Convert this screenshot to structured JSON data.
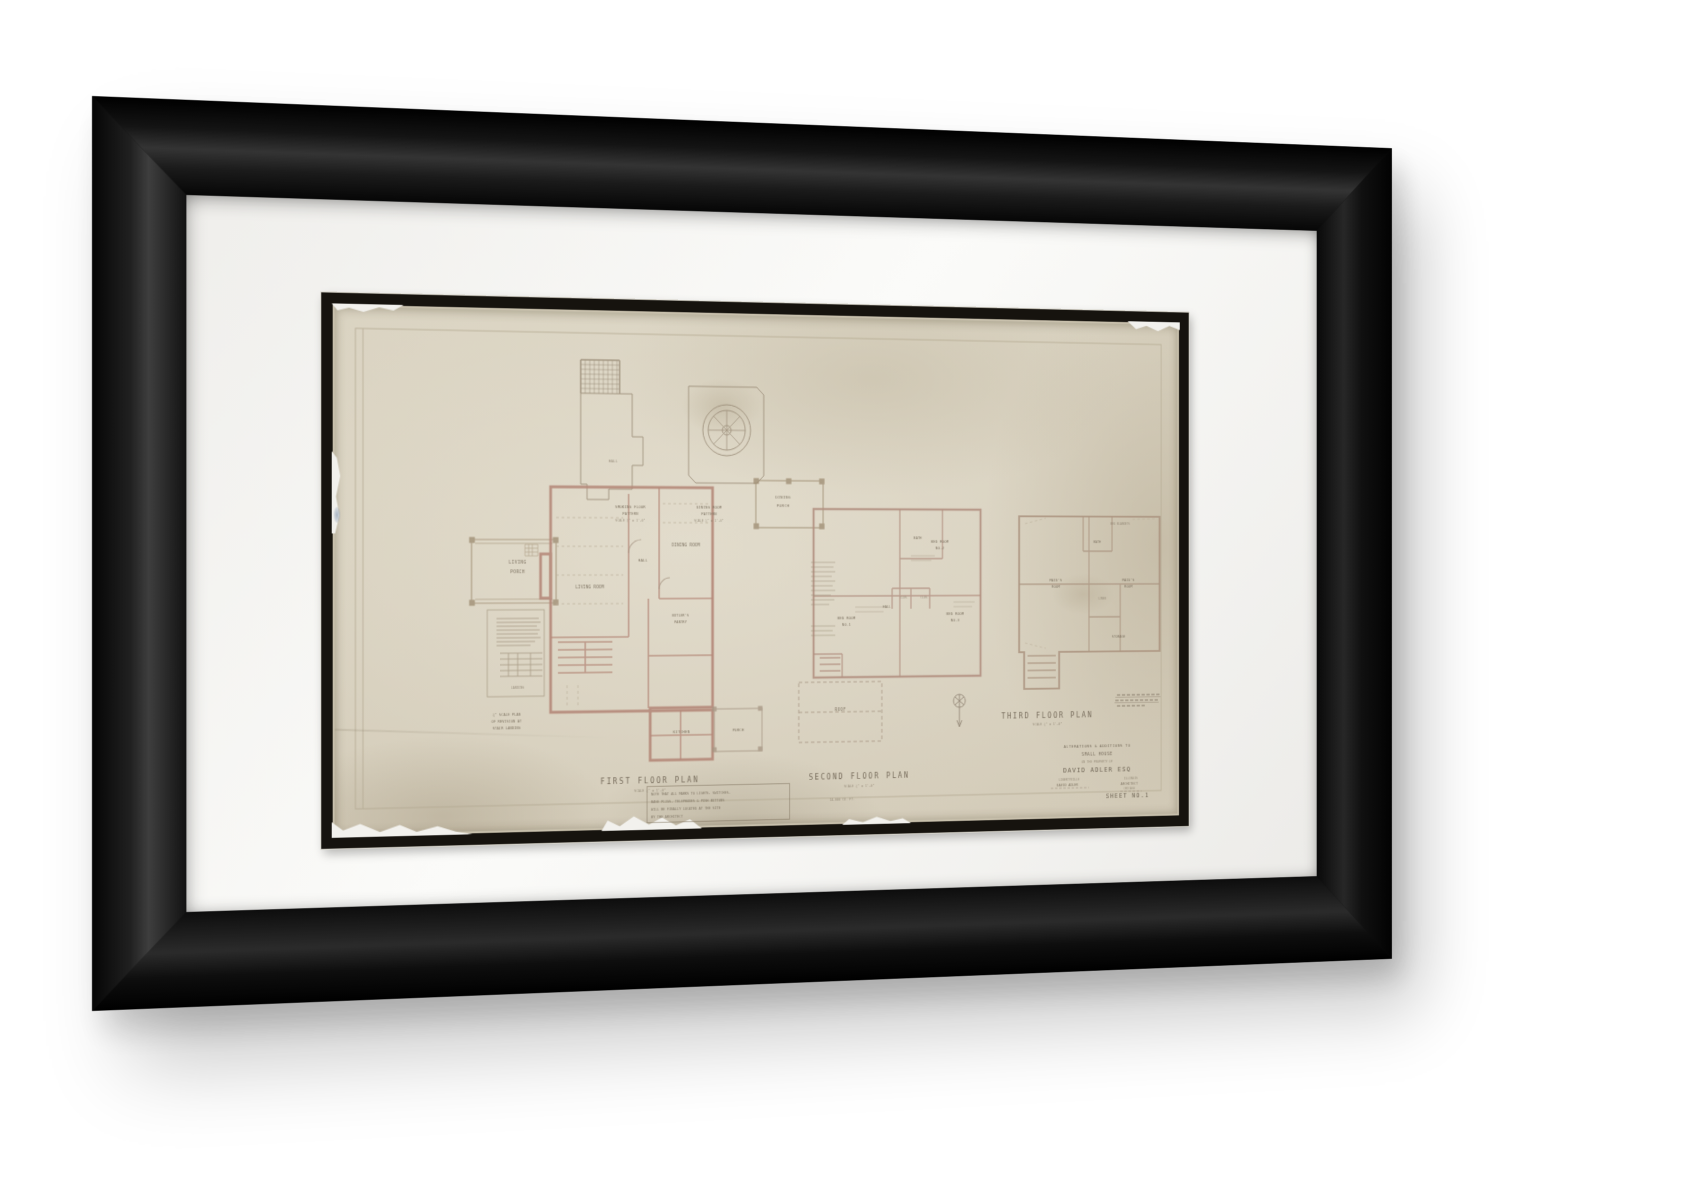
{
  "artwork": {
    "details": {
      "smoking_pattern": {
        "room": "HALL",
        "label1": "SMOKING FLOOR",
        "label2": "PATTERN",
        "scale": "SCALE ½\" = 1'-0\""
      },
      "dining_pattern": {
        "label1": "DINING ROOM",
        "label2": "PATTERN",
        "scale": "SCALE ½\" = 1'-0\""
      },
      "stair_detail": {
        "landing": "LANDING",
        "label1": "¼\" SCALE PLAN",
        "label2": "OF REVISION AT",
        "label3": "STAIR LANDING"
      }
    },
    "first_floor": {
      "title": "FIRST FLOOR PLAN",
      "scale": "SCALE ¼\" = 1'-0\"",
      "rooms": {
        "living": "LIVING ROOM",
        "hall": "HALL",
        "dining": "DINING ROOM",
        "butlers1": "BUTLER'S",
        "butlers2": "PANTRY",
        "kitchen": "KITCHEN",
        "porch": "PORCH",
        "living_porch1": "LIVING",
        "living_porch2": "PORCH",
        "dining_porch1": "DINING",
        "dining_porch2": "PORCH"
      }
    },
    "second_floor": {
      "title": "SECOND FLOOR PLAN",
      "scale": "SCALE ¼\" = 1'-0\"",
      "rooms": {
        "bed1a": "BED ROOM",
        "bed1b": "NO.1",
        "bed2a": "BED ROOM",
        "bed2b": "NO.2",
        "bed3a": "BED ROOM",
        "bed3b": "NO.3",
        "hall": "HALL",
        "bath": "BATH",
        "clos1": "CLOS.",
        "clos2": "CLOS.",
        "roof": "ROOF"
      }
    },
    "third_floor": {
      "title": "THIRD FLOOR PLAN",
      "scale": "SCALE ¼\" = 1'-0\"",
      "note": "BED BLANKETS",
      "rooms": {
        "maids1a": "MAID'S",
        "maids1b": "ROOM",
        "maids2a": "MAID'S",
        "maids2b": "ROOM",
        "bath": "BATH",
        "linen": "LINEN",
        "storage": "STORAGE"
      }
    },
    "note_box": {
      "l1": "NOTE THAT ALL MARKS TO LIGHTS, SWITCHES,",
      "l2": "BASE PLUGS, TELEPHONES & PUSH BUTTONS",
      "l3": "WILL BE FINALLY LOCATED AT THE SITE",
      "l4": "BY THE ARCHITECT"
    },
    "cubage": "14,000 CU. FT.",
    "title_block": {
      "l1": "ALTERATIONS & ADDITIONS TO",
      "l2": "SMALL HOUSE",
      "l3": "ON THE PROPERTY OF",
      "client": "DAVID ADLER ESQ",
      "place_l": "LIBERTYVILLE",
      "place_r": "ILLINOIS",
      "arch_l": "DAVID ADLER",
      "arch_r": "ARCHITECT",
      "city": "CHICAGO",
      "sheet": "SHEET NO.1"
    },
    "colors": {
      "paper": "#d8d1bf",
      "walls": "#b5897a",
      "ink": "#8a7e6d",
      "fillet": "#16130e"
    }
  }
}
